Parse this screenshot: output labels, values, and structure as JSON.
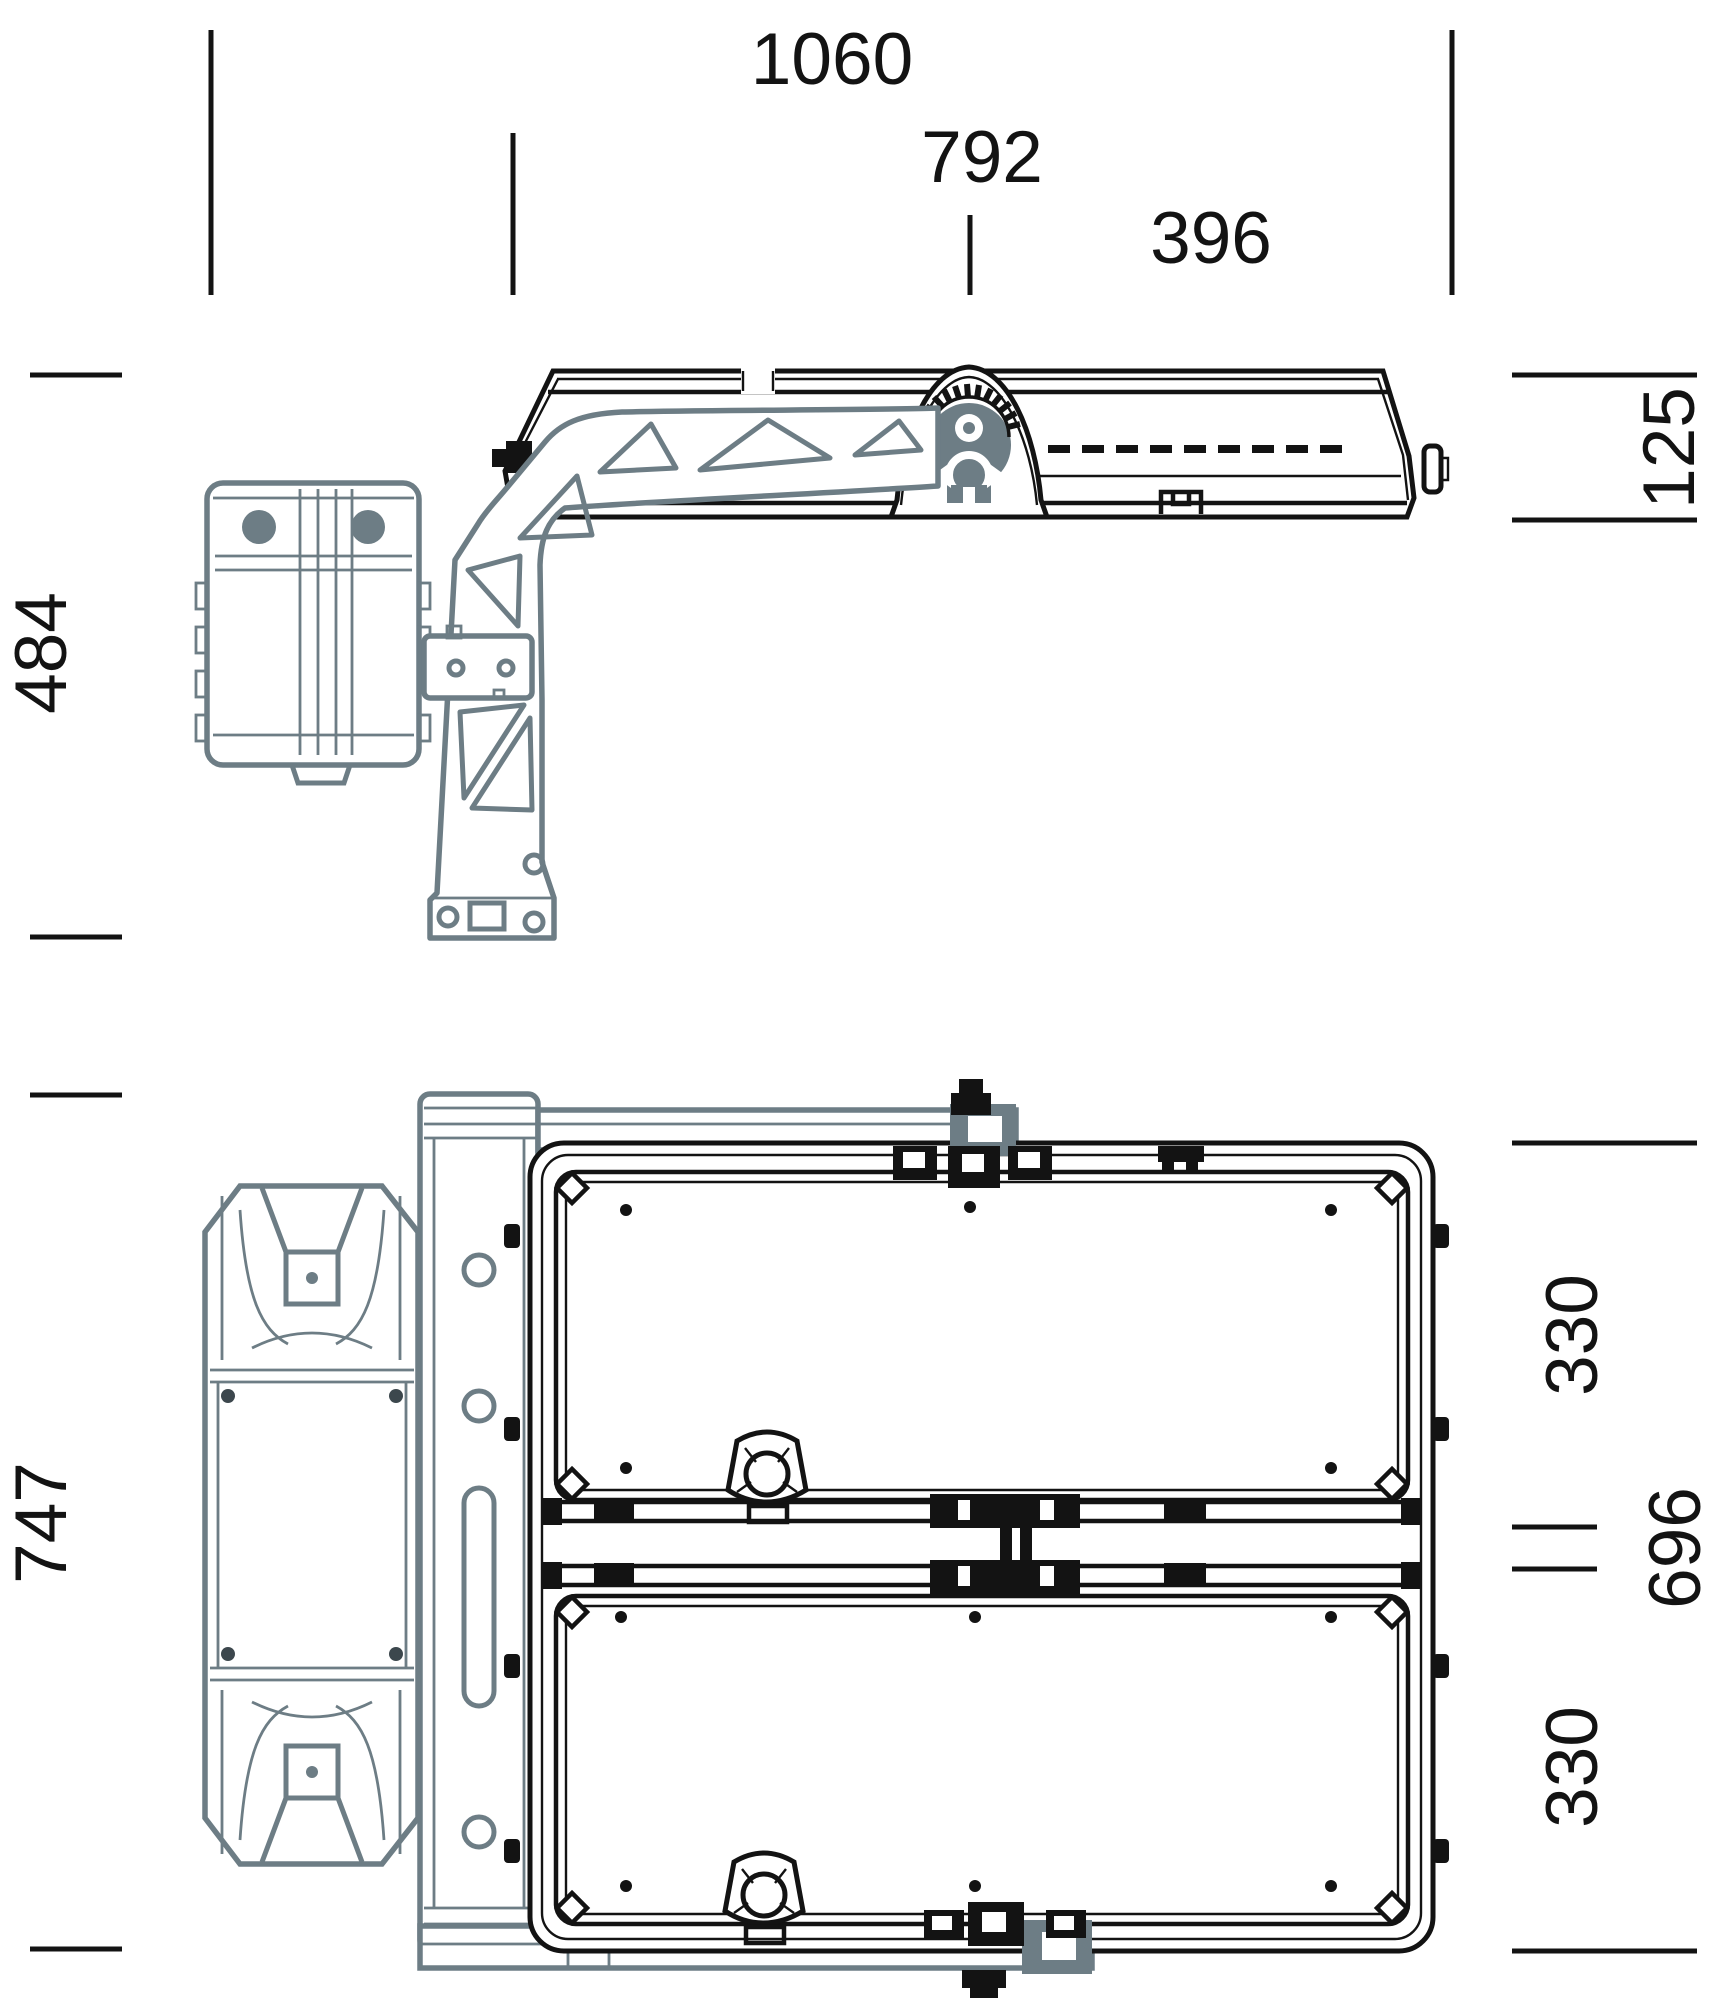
{
  "drawing": {
    "kind": "technical dimension drawing",
    "subject": "flood light luminaire with pivot bracket and drive motor, side view and plan view",
    "units": "mm"
  },
  "dimensions": {
    "top": {
      "overall_width": "1060",
      "fixture_width": "792",
      "pivot_to_end": "396"
    },
    "side_view": {
      "assembly_height": "484",
      "fixture_height": "125"
    },
    "plan_view": {
      "assembly_depth": "747",
      "fixture_depth": "696",
      "module_depth_top": "330",
      "module_depth_bottom": "330"
    }
  },
  "colors": {
    "line": "#131313",
    "bracket_gray": "#6d7d85",
    "background": "#ffffff"
  }
}
